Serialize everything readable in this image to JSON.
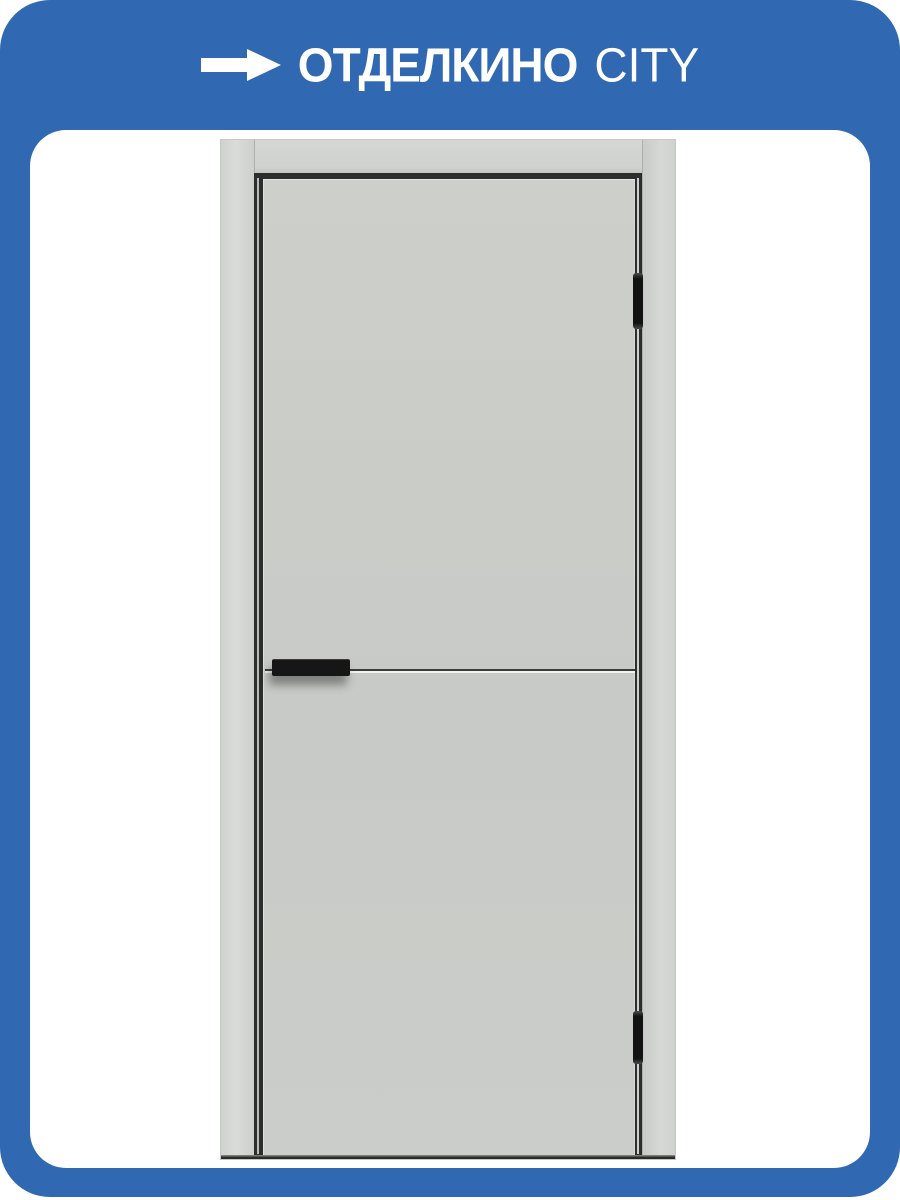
{
  "banner": {
    "brand_primary": "ОТДЕЛКИНО",
    "brand_secondary": "CITY",
    "icon": "arrow-right-icon"
  },
  "product_image": {
    "alt": "Светло-серая межкомнатная дверь с чёрной торцевой ручкой, горизонтальным молдингом и двумя чёрными скрытыми петлями"
  },
  "colors": {
    "banner_blue": "#3168b2",
    "card_white": "#ffffff",
    "door_leaf_gray": "#c9cbc8",
    "door_frame_gray": "#d3d5d2",
    "gap_dark": "#2c2e2d",
    "hardware_black": "#161616",
    "brand_text": "#ffffff"
  }
}
